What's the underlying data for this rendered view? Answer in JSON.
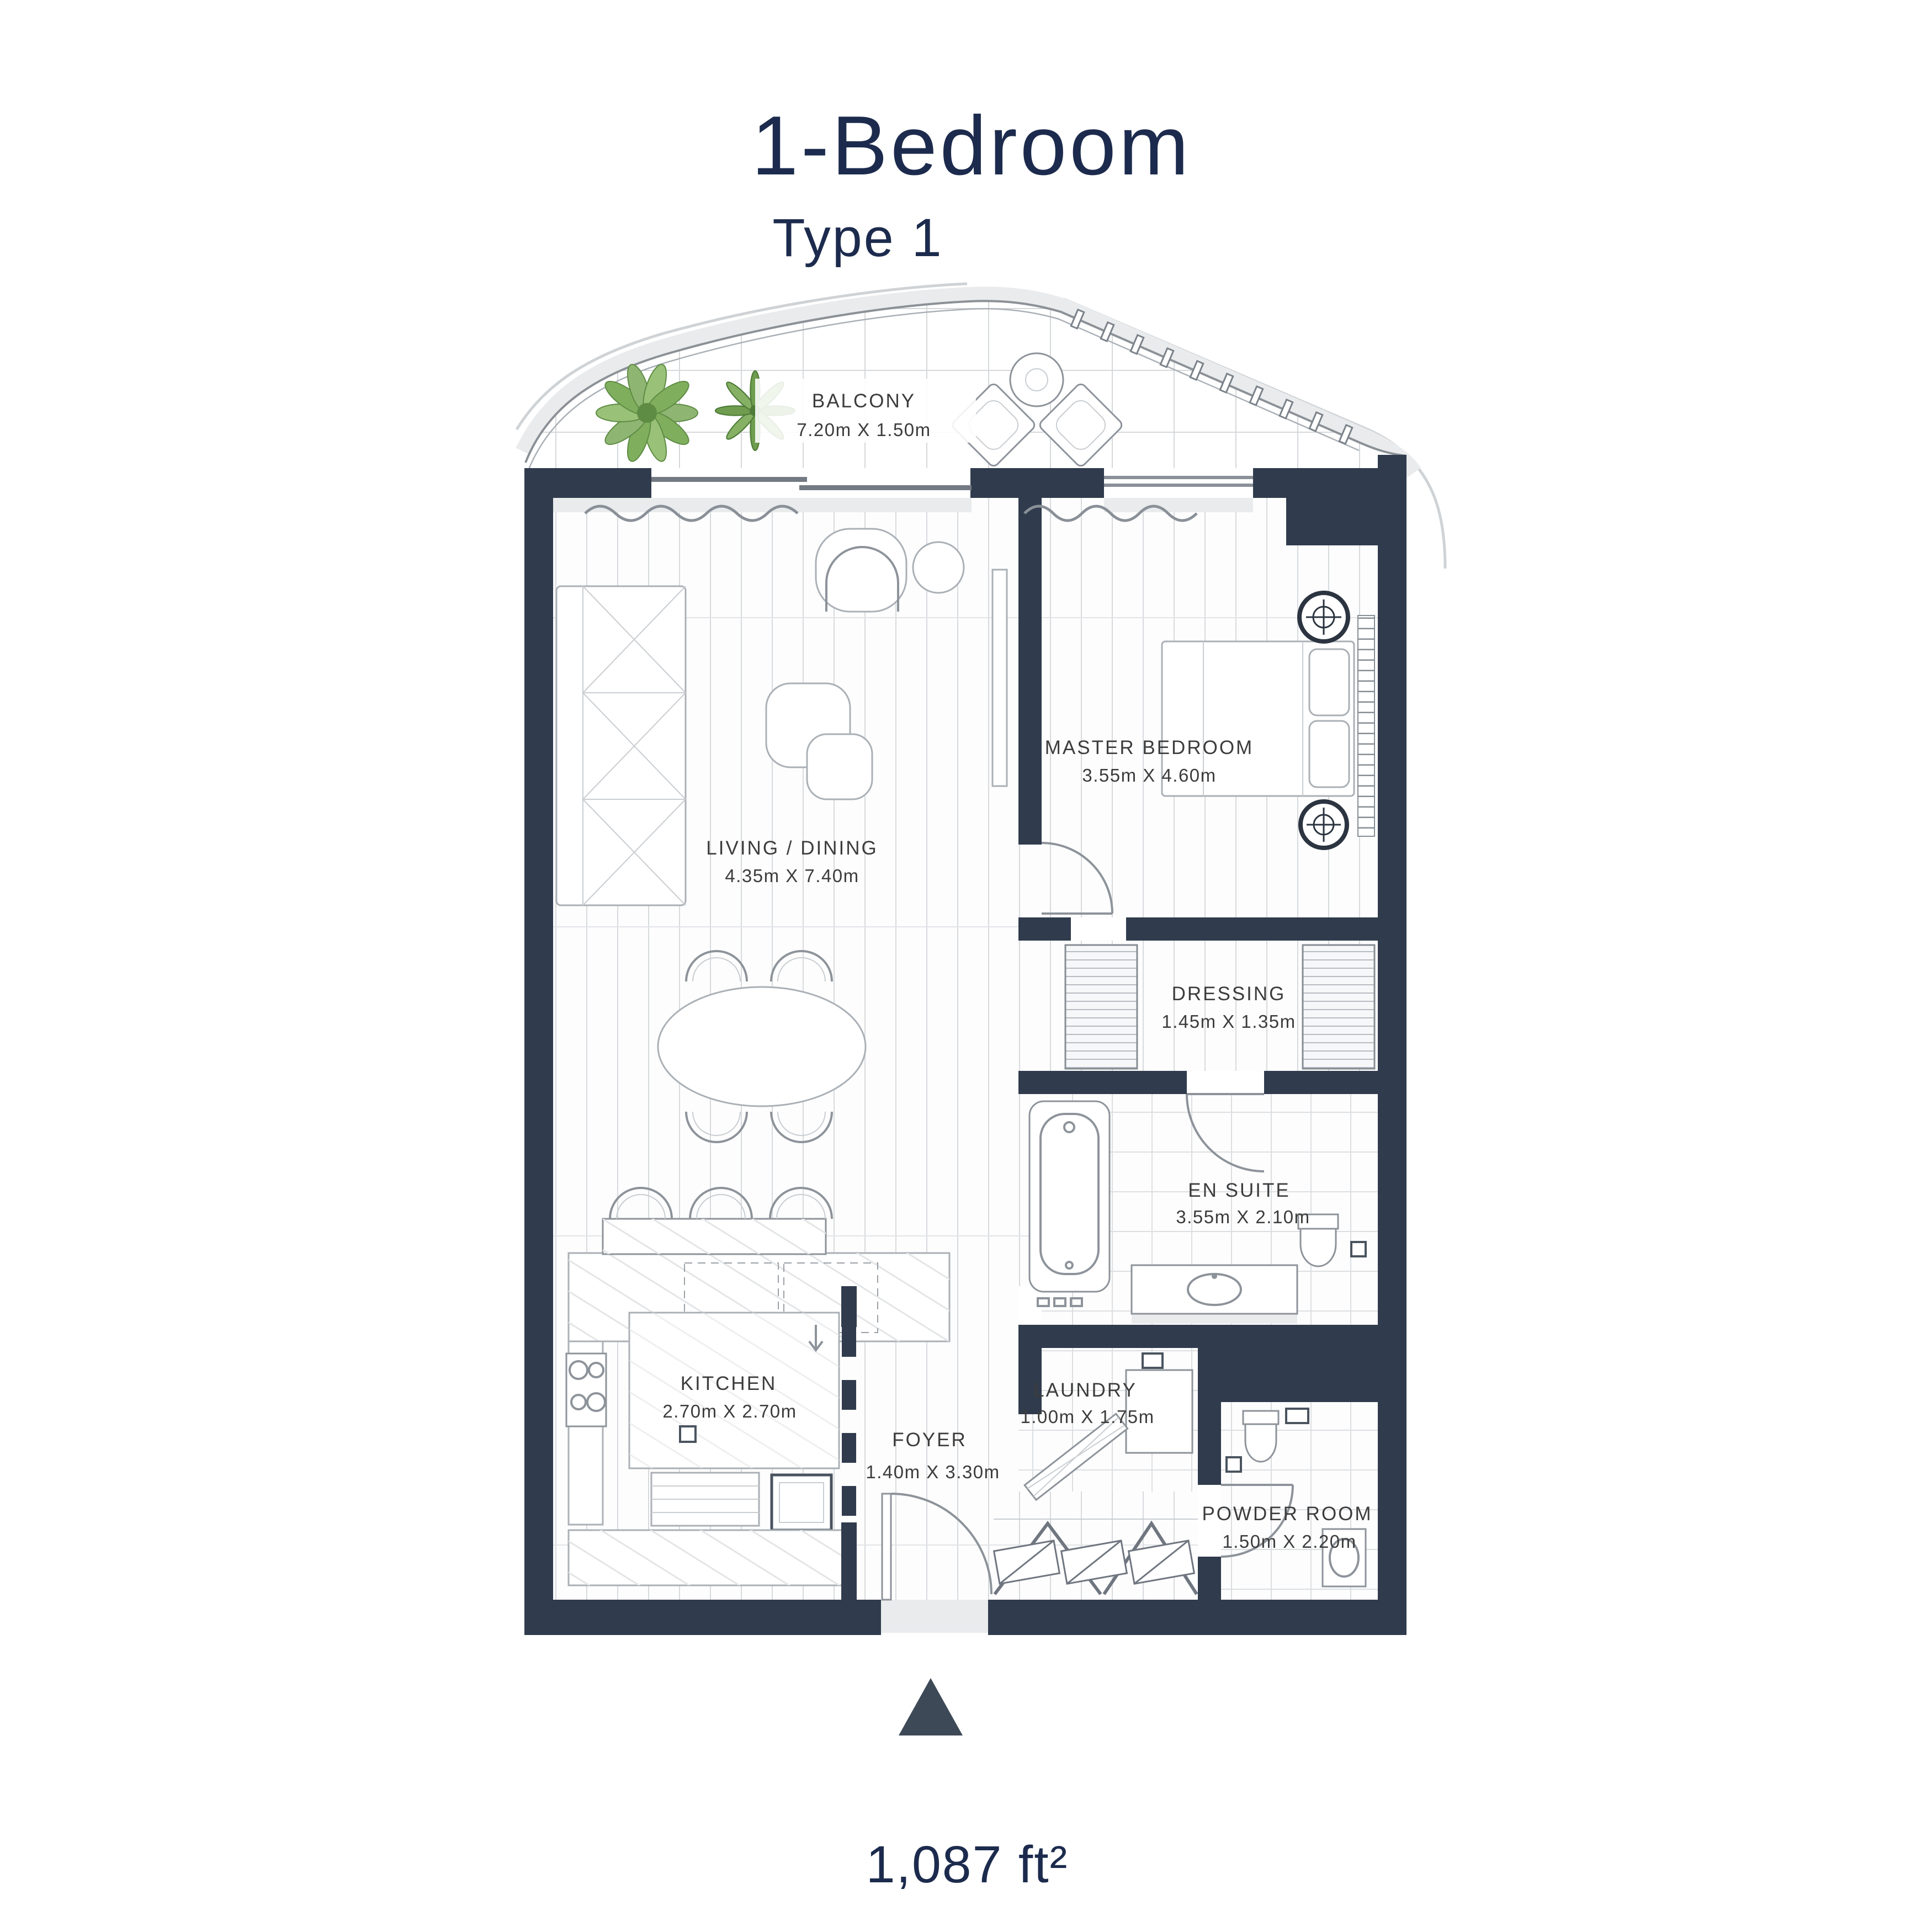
{
  "header": {
    "title": "1-Bedroom",
    "subtitle": "Type 1"
  },
  "rooms": [
    {
      "id": "balcony",
      "name": "BALCONY",
      "dims": "7.20m X 1.50m"
    },
    {
      "id": "living-dining",
      "name": "LIVING / DINING",
      "dims": "4.35m X 7.40m"
    },
    {
      "id": "master-bedroom",
      "name": "MASTER BEDROOM",
      "dims": "3.55m X 4.60m"
    },
    {
      "id": "dressing",
      "name": "DRESSING",
      "dims": "1.45m X 1.35m"
    },
    {
      "id": "en-suite",
      "name": "EN SUITE",
      "dims": "3.55m X 2.10m"
    },
    {
      "id": "kitchen",
      "name": "KITCHEN",
      "dims": "2.70m X 2.70m"
    },
    {
      "id": "foyer",
      "name": "FOYER",
      "dims": "1.40m X 3.30m"
    },
    {
      "id": "laundry",
      "name": "LAUNDRY",
      "dims": "1.00m X 1.75m"
    },
    {
      "id": "powder-room",
      "name": "POWDER ROOM",
      "dims": "1.50m X 2.20m"
    }
  ],
  "footer": {
    "area": "1,087 ft²",
    "north_icon": "north-arrow"
  },
  "colors": {
    "wall": "#303c4d",
    "title": "#1c2b4d",
    "label": "#3c3c3c",
    "fixture": "#8d939a",
    "shadow": "#e9ebed",
    "arrow": "#3d4956",
    "plant_dark": "#5e8c44",
    "plant_light": "#8fb573"
  }
}
